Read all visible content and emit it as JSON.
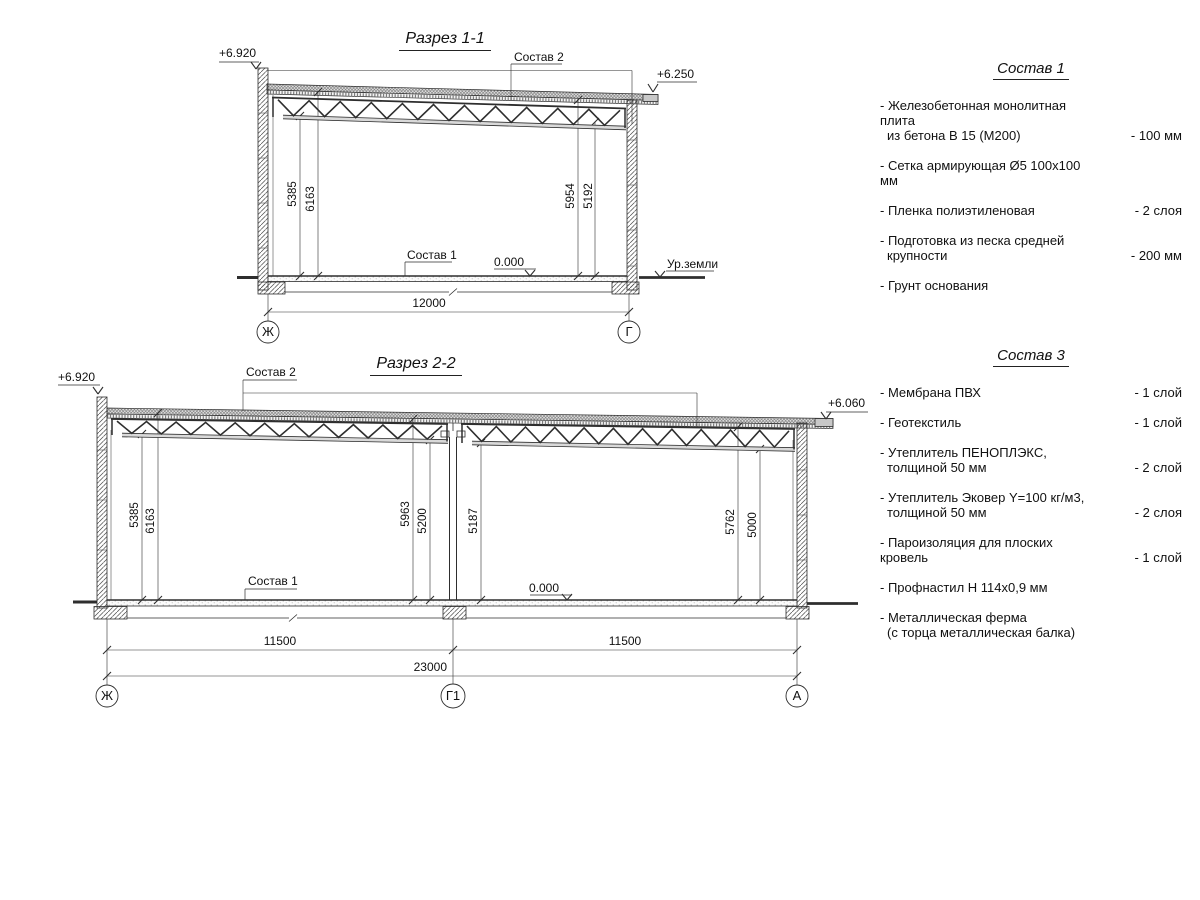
{
  "s1": {
    "title": "Разрез 1-1",
    "elev_left": "+6.920",
    "elev_right": "+6.250",
    "roof_callout": "Состав 2",
    "floor_callout": "Состав 1",
    "zero": "0.000",
    "ground": "Ур.земли",
    "dims_vertical": [
      "5385",
      "6163",
      "5954",
      "5192"
    ],
    "span": "12000",
    "axes": [
      "Ж",
      "Г"
    ]
  },
  "s2": {
    "title": "Разрез 2-2",
    "elev_left": "+6.920",
    "elev_right": "+6.060",
    "roof_callout": "Состав 2",
    "floor_callout": "Состав 1",
    "zero": "0.000",
    "dims_vertical": [
      "5385",
      "6163",
      "5963",
      "5200",
      "5187",
      "5762",
      "5000"
    ],
    "span_left": "11500",
    "span_right": "11500",
    "span_total": "23000",
    "axes": [
      "Ж",
      "Г1",
      "А"
    ]
  },
  "c1": {
    "title": "Состав 1",
    "items": [
      {
        "l1": "- Железобетонная  монолитная плита",
        "l2": "из бетона В 15 (М200)",
        "v": "- 100 мм"
      },
      {
        "l1": "- Сетка армирующая Ø5 100х100 мм",
        "l2": "",
        "v": ""
      },
      {
        "l1": "- Пленка полиэтиленовая",
        "l2": "",
        "v": "-  2 слоя"
      },
      {
        "l1": "- Подготовка из песка средней",
        "l2": "крупности",
        "v": "- 200 мм"
      },
      {
        "l1": "- Грунт основания",
        "l2": "",
        "v": ""
      }
    ]
  },
  "c3": {
    "title": "Состав 3",
    "items": [
      {
        "l1": "- Мембрана ПВХ",
        "l2": "",
        "v": "- 1 слой"
      },
      {
        "l1": "- Геотекстиль",
        "l2": "",
        "v": "- 1 слой"
      },
      {
        "l1": "- Утеплитель ПЕНОПЛЭКС,",
        "l2": "толщиной 50 мм",
        "v": "- 2 слой"
      },
      {
        "l1": "- Утеплитель Эковер Y=100 кг/м3,",
        "l2": "толщиной 50 мм",
        "v": "- 2 слоя"
      },
      {
        "l1": "- Пароизоляция для плоских кровель",
        "l2": "",
        "v": "- 1 слой"
      },
      {
        "l1": "- Профнастил Н 114х0,9 мм",
        "l2": "",
        "v": ""
      },
      {
        "l1": "- Металлическая ферма",
        "l2": "(с торца металлическая балка)",
        "v": ""
      }
    ]
  }
}
